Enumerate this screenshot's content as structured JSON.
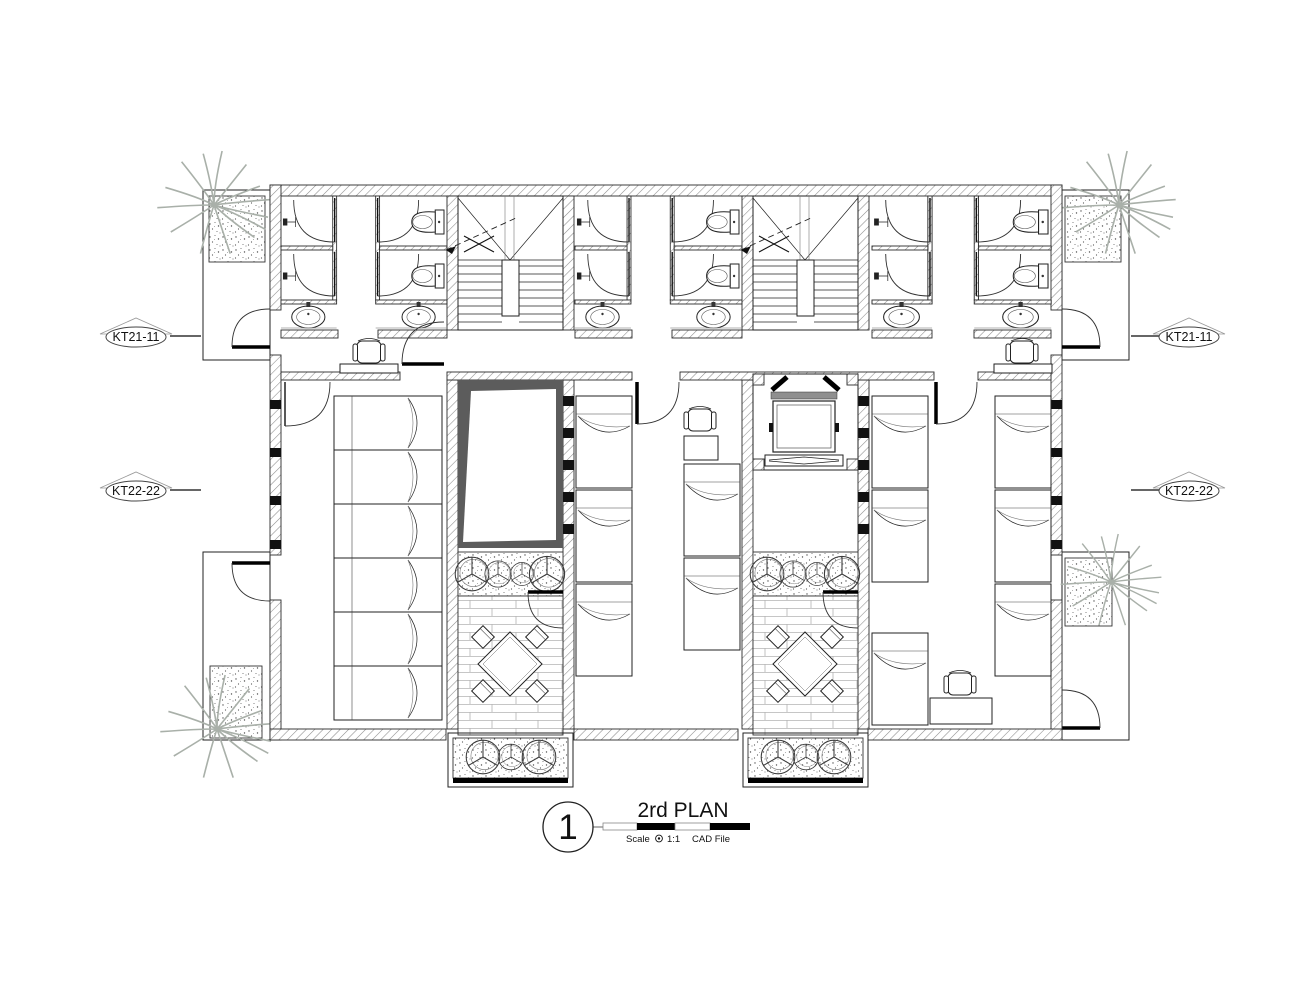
{
  "drawing": {
    "background": "#ffffff",
    "title_block": {
      "detail_number": "1",
      "title": "2rd PLAN",
      "scale_label": "Scale",
      "scale_value": "1:1",
      "file_label": "CAD File"
    },
    "section_markers": {
      "left": [
        {
          "label": "KT21-11"
        },
        {
          "label": "KT22-22"
        }
      ],
      "right": [
        {
          "label": "KT21-11"
        },
        {
          "label": "KT22-22"
        }
      ]
    },
    "colors": {
      "line": "#1f1f1f",
      "wall_hatch": "#8c8c8c",
      "void_shadow": "#5c5c5c",
      "elevator_sill": "#8f8f8f",
      "vegetation": "#a9b0a9",
      "brick_line": "#b3b3b3"
    }
  }
}
